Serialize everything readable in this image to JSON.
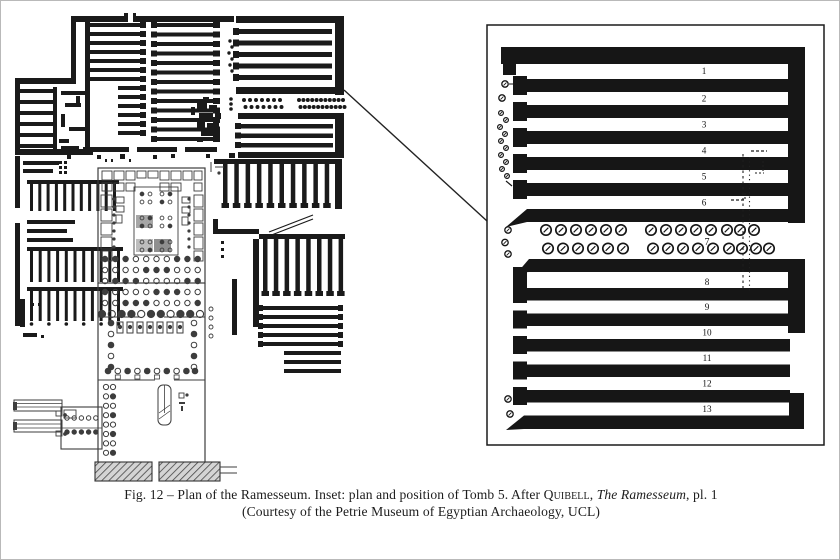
{
  "caption": {
    "line1_segments": [
      {
        "text": "Fig. 12 – Plan of the Ramesseum. Inset: plan and position of Tomb 5. After ",
        "style": "normal"
      },
      {
        "text": "Quibell",
        "style": "smallcaps"
      },
      {
        "text": ", ",
        "style": "normal"
      },
      {
        "text": "The Ramesseum",
        "style": "italic"
      },
      {
        "text": ", pl. 1",
        "style": "normal"
      }
    ],
    "line2": "(Courtesy of the Petrie Museum of Egyptian Archaeology, UCL)"
  },
  "inset": {
    "upper_room_numbers": [
      "1",
      "2",
      "3",
      "4",
      "5",
      "6"
    ],
    "colonnade_label": "7",
    "lower_room_numbers": [
      "8",
      "9",
      "10",
      "11",
      "12",
      "13"
    ]
  },
  "colors": {
    "ink": "#1a1a1a",
    "inset_ink": "#161616",
    "temple_line": "#3d3d3d",
    "paper": "#ffffff",
    "pylon_fill": "#d4d4d4",
    "hatch_line": "#454545",
    "label_ink": "#111111"
  }
}
